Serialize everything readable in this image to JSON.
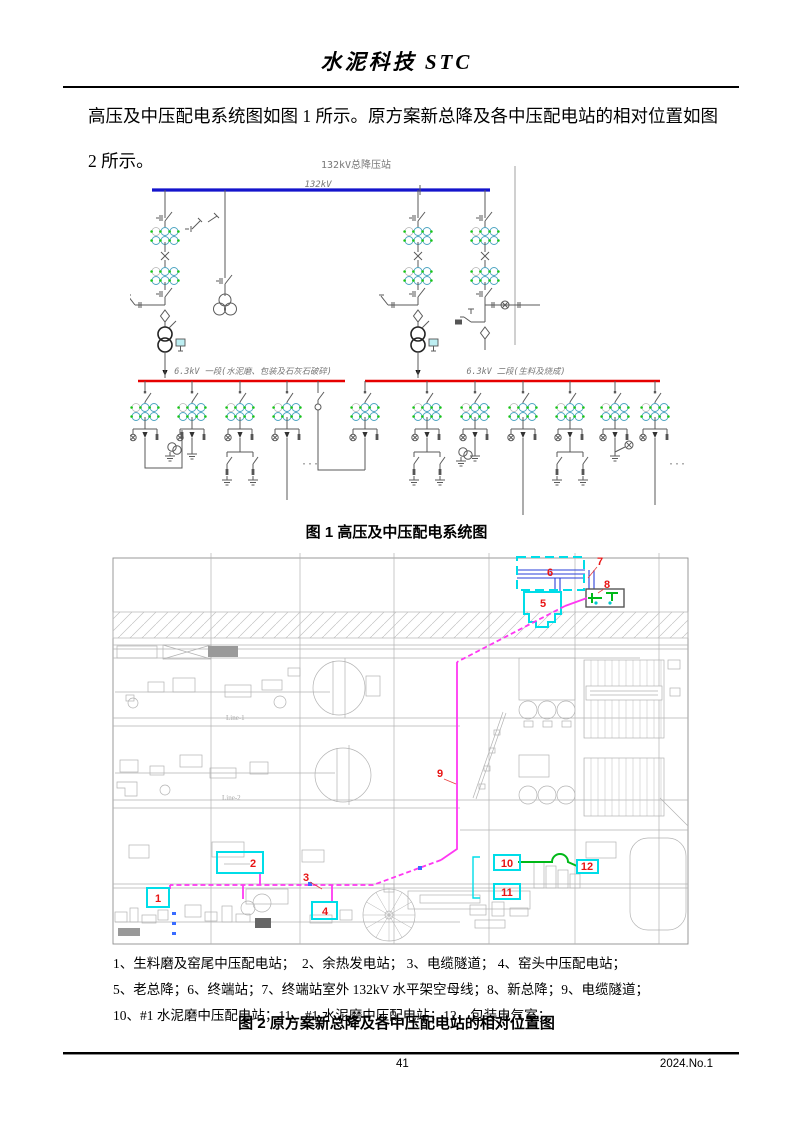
{
  "header": {
    "journal_title": "水泥科技 STC"
  },
  "body": {
    "paragraph": "高压及中压配电系统图如图 1 所示。原方案新总降及各中压配电站的相对位置如图 2 所示。"
  },
  "figure1": {
    "station_title": "132kV总降压站",
    "hv_bus_label": "132kV",
    "bus1_label": "6.3kV 一段(水泥磨、包装及石灰石破碎)",
    "bus2_label": "6.3kV 二段(生料及烧成)",
    "ellipsis": "···",
    "caption": "图 1 高压及中压配电系统图",
    "colors": {
      "hv_bus": "#1414cc",
      "mv_bus": "#e60000",
      "ct_green": "#18c418",
      "ct_cyan": "#4aa3c0"
    }
  },
  "figure2": {
    "plan_label_line1": "Line-1",
    "plan_label_line2": "Line-2",
    "markers": [
      "1",
      "2",
      "3",
      "4",
      "5",
      "6",
      "7",
      "8",
      "9",
      "10",
      "11",
      "12"
    ],
    "legend": [
      "1、生料磨及窑尾中压配电站；　2、余热发电站； 3、电缆隧道； 4、窑头中压配电站；",
      "5、老总降；6、终端站；7、终端站室外 132kV 水平架空母线；8、新总降；9、电缆隧道；",
      "10、#1 水泥磨中压配电站；11、#1 水泥磨中压配电站；12、包装电气室；"
    ],
    "caption": "图 2 原方案新总降及各中压配电站的相对位置图",
    "colors": {
      "route": "#ff38f2",
      "marker_box": "#00dde8",
      "marker_num": "#e81414",
      "overhead_bus": "#2a3fd8",
      "link": "#00b818"
    }
  },
  "footer": {
    "page_number": "41",
    "issue": "2024.No.1"
  }
}
